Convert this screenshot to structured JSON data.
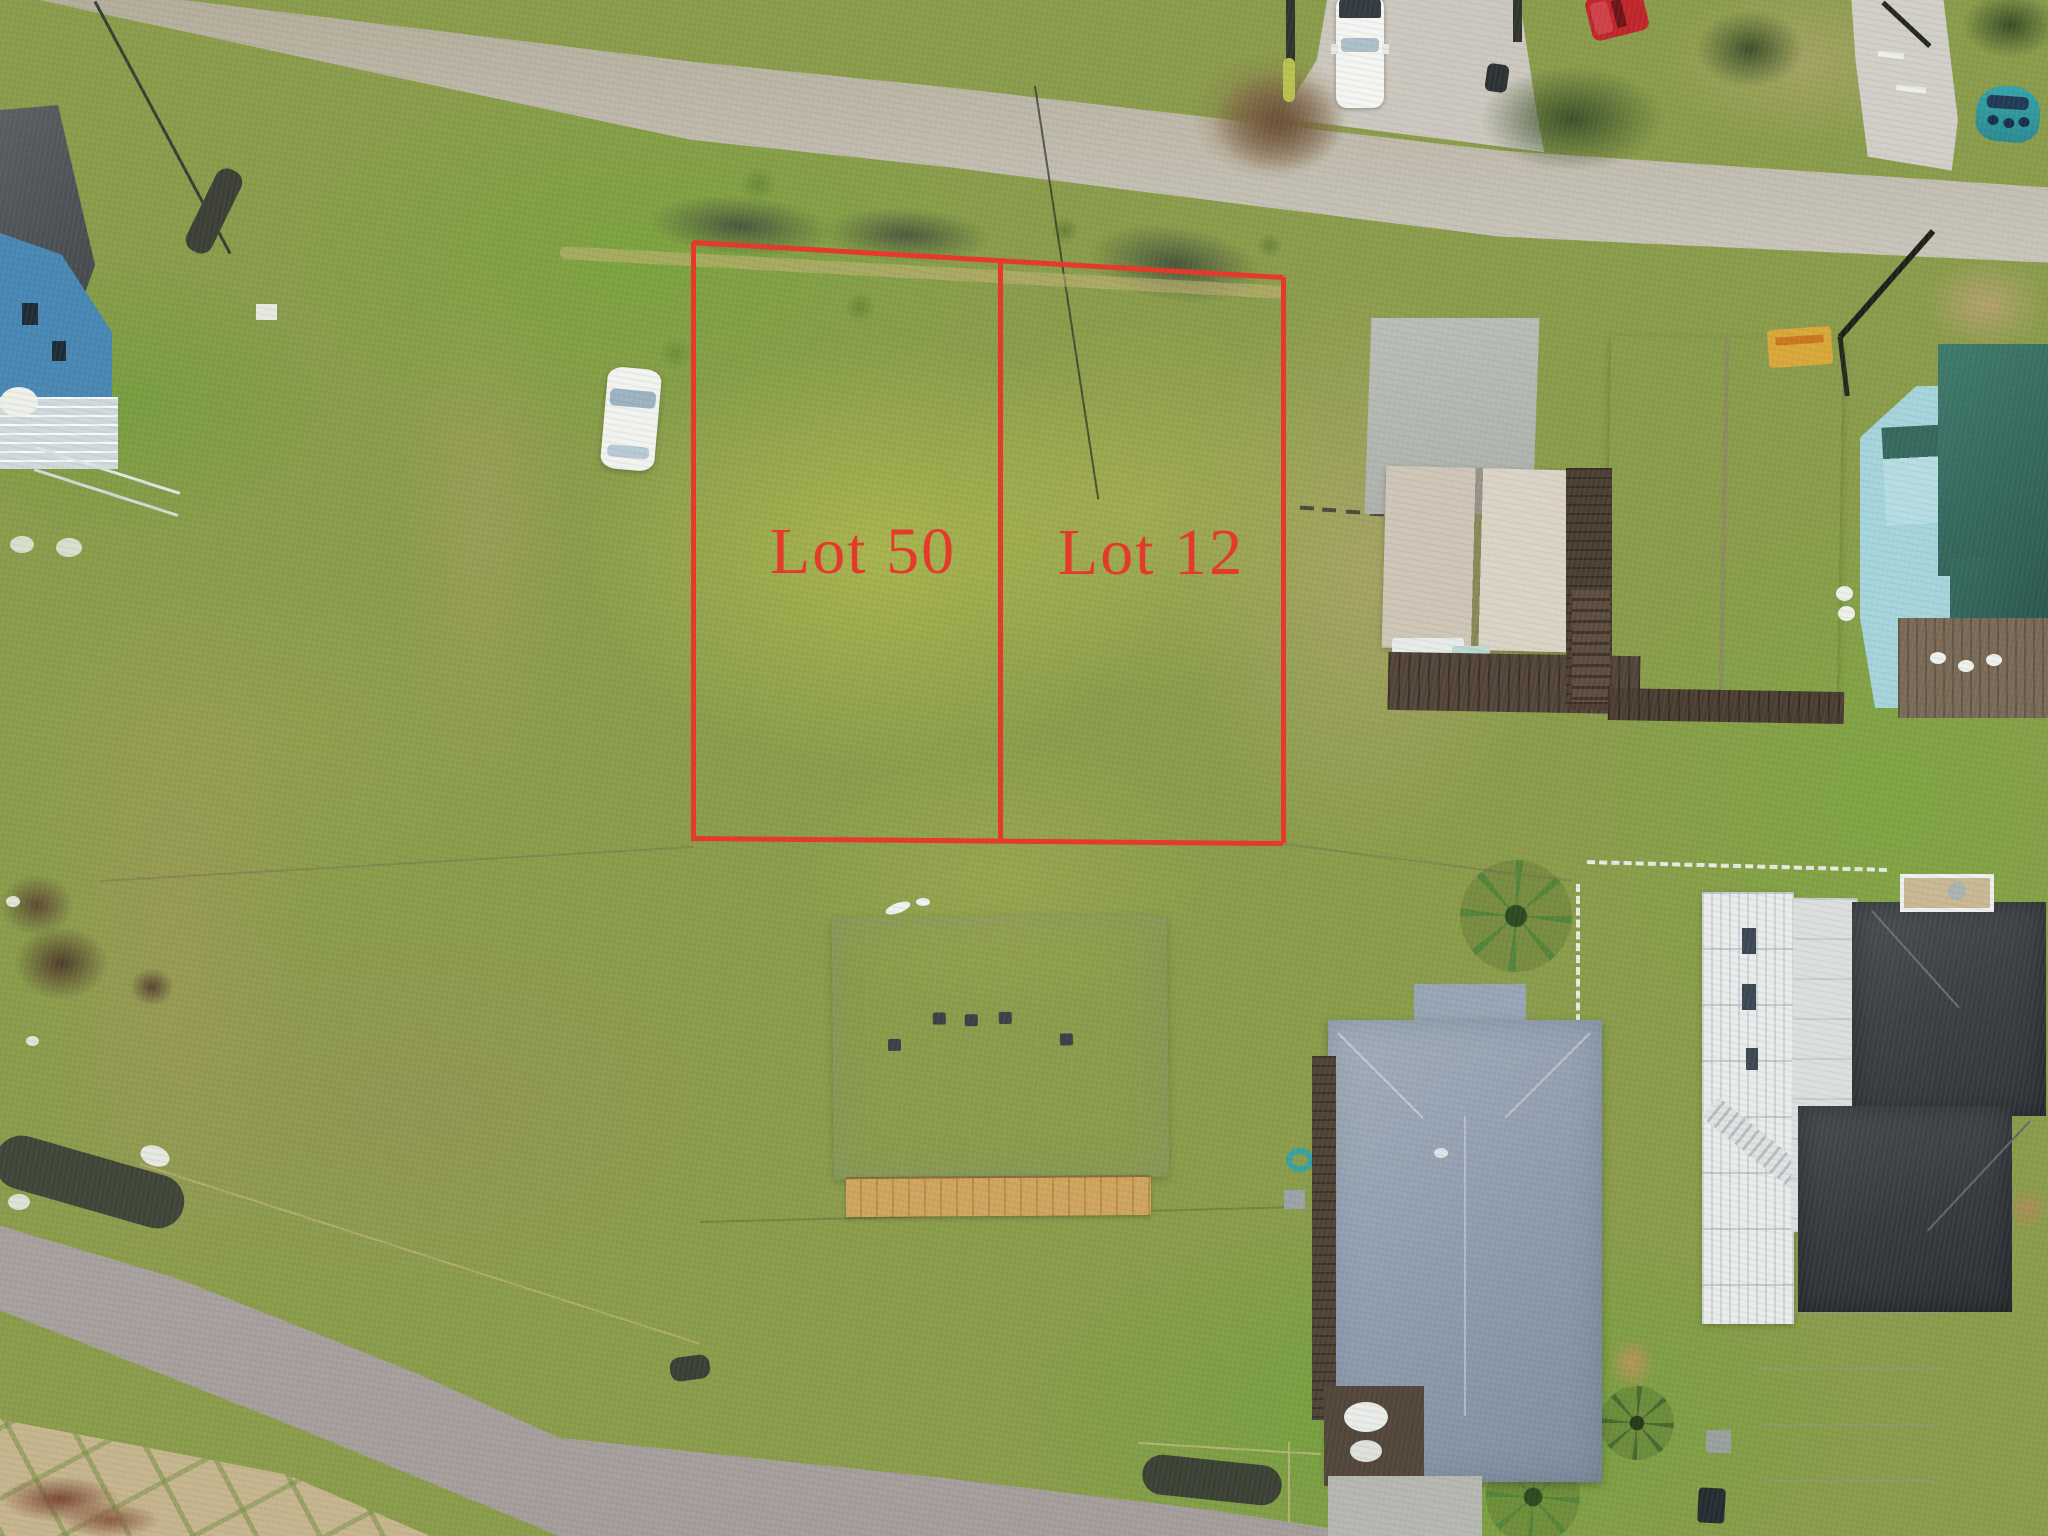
{
  "annotation": {
    "lot_labels": [
      "Lot 50",
      "Lot 12"
    ],
    "outline_color": "#E5392B",
    "label_color": "#E5392B"
  },
  "scene": {
    "grass_base_color": "#8A9C4B",
    "road_color": "#CDC9C2",
    "center_house_roof_color": "#D5DAE0",
    "center_house_siding_color": "#C89E5A",
    "left_house_wall_color": "#4887B5",
    "beach_house_roof_color": "#D9CFC2",
    "teal_house_roof_color": "#35685E",
    "bluegray_house_roof_color": "#93A2B4",
    "dark_house_roof_color": "#3B4045",
    "boat_color": "#35A3AB",
    "red_truck_color": "#C1242B"
  }
}
